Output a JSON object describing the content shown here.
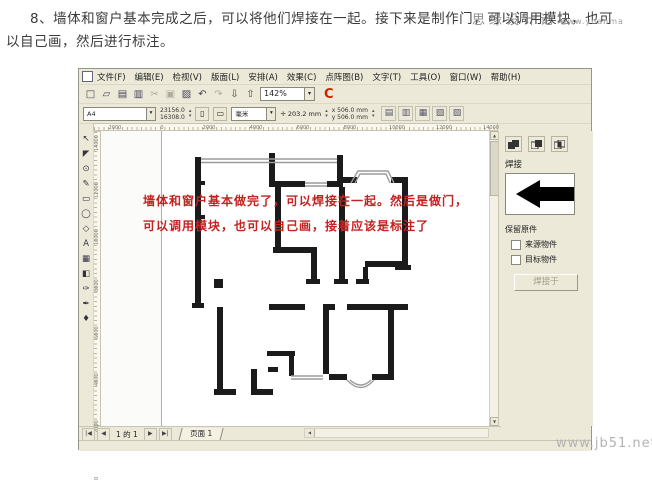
{
  "tutorial": {
    "line1": "8、墙体和窗户基本完成之后，可以将他们焊接在一起。接下来是制作门，可以调用模块，也可",
    "line2": "以自己画，然后进行标注。",
    "watermark_overlay": "思缘设计论坛",
    "watermark_small": "www.yuanma",
    "watermark_bottom": "www.jb51.net"
  },
  "app": {
    "menu": [
      "文件(F)",
      "编辑(E)",
      "检视(V)",
      "版面(L)",
      "安排(A)",
      "效果(C)",
      "点阵图(B)",
      "文字(T)",
      "工具(O)",
      "窗口(W)",
      "帮助(H)"
    ],
    "toolbar": {
      "zoom_level": "142%",
      "logo": "C",
      "icons": [
        {
          "name": "new-document",
          "glyph": "□",
          "gray": false
        },
        {
          "name": "open-folder",
          "glyph": "▱",
          "gray": false
        },
        {
          "name": "save",
          "glyph": "▤",
          "gray": false
        },
        {
          "name": "print",
          "glyph": "▥",
          "gray": false
        },
        {
          "name": "cut",
          "glyph": "✂",
          "gray": true
        },
        {
          "name": "copy",
          "glyph": "▣",
          "gray": true
        },
        {
          "name": "paste",
          "glyph": "▨",
          "gray": false
        },
        {
          "name": "undo",
          "glyph": "↶",
          "gray": false
        },
        {
          "name": "redo",
          "glyph": "↷",
          "gray": true
        },
        {
          "name": "import",
          "glyph": "⇩",
          "gray": false
        },
        {
          "name": "export",
          "glyph": "⇧",
          "gray": false
        }
      ]
    },
    "property_bar": {
      "paper_size": "A4",
      "width_value": "23156.0",
      "height_value": "16308.0",
      "portrait_glyph": "▯",
      "landscape_glyph": "▭",
      "units": "毫米",
      "nudge": "203.2 mm",
      "dup_x": "506.0 mm",
      "dup_y": "506.0 mm",
      "align_icons": [
        "▤",
        "▥",
        "▦",
        "▧",
        "▨"
      ]
    },
    "rulers": {
      "h_labels": [
        "2000",
        "0",
        "2000",
        "4000",
        "6000",
        "8000",
        "10000",
        "12000",
        "14000"
      ],
      "h_positions": [
        21,
        68,
        115,
        162,
        209,
        256,
        303,
        350,
        397
      ],
      "v_labels": [
        "14000",
        "12000",
        "10000",
        "8000",
        "6000",
        "4000",
        "2000",
        "0"
      ],
      "v_positions": [
        11,
        58,
        105,
        152,
        199,
        246,
        293,
        340
      ]
    },
    "toolbox": [
      {
        "name": "pick-tool",
        "glyph": "↖"
      },
      {
        "name": "shape-tool",
        "glyph": "◤"
      },
      {
        "name": "zoom-tool",
        "glyph": "⊙"
      },
      {
        "name": "freehand-tool",
        "glyph": "✎"
      },
      {
        "name": "rectangle-tool",
        "glyph": "▭"
      },
      {
        "name": "ellipse-tool",
        "glyph": "◯"
      },
      {
        "name": "polygon-tool",
        "glyph": "◇"
      },
      {
        "name": "text-tool",
        "glyph": "A"
      },
      {
        "name": "interactive-blend-tool",
        "glyph": "▦"
      },
      {
        "name": "interactive-transparency-tool",
        "glyph": "◧"
      },
      {
        "name": "eyedropper-tool",
        "glyph": "✑"
      },
      {
        "name": "outline-tool",
        "glyph": "✒"
      },
      {
        "name": "fill-tool",
        "glyph": "♦"
      }
    ],
    "docker": {
      "mode_label": "焊接",
      "keep_label": "保留原件",
      "source_label": "来源物件",
      "target_label": "目标物件",
      "apply_label": "焊接于"
    },
    "nav": {
      "first": "|◀",
      "prev": "◀",
      "page_info": "1 的 1",
      "next": "▶",
      "last": "▶|",
      "tab": "页面 1"
    }
  },
  "canvas": {
    "annotation_line1": "墙体和窗户基本做完了，可以焊接在一起。然后是做门，",
    "annotation_line2": "可以调用模块，也可以自己画，接着应该是标注了",
    "annotation_color": "#c52222",
    "floor_plan": {
      "wall_color": "#1b1b1b",
      "window_color": "#9b9b9b",
      "walls": [
        [
          94,
          26,
          6,
          148
        ],
        [
          91,
          172,
          12,
          5
        ],
        [
          100,
          50,
          4,
          4
        ],
        [
          100,
          84,
          4,
          4
        ],
        [
          168,
          22,
          6,
          34
        ],
        [
          168,
          50,
          36,
          6
        ],
        [
          226,
          50,
          16,
          6
        ],
        [
          236,
          24,
          6,
          28
        ],
        [
          236,
          46,
          20,
          6
        ],
        [
          290,
          46,
          17,
          6
        ],
        [
          301,
          46,
          6,
          92
        ],
        [
          294,
          134,
          16,
          5
        ],
        [
          174,
          56,
          6,
          62
        ],
        [
          172,
          116,
          44,
          6
        ],
        [
          210,
          122,
          6,
          28
        ],
        [
          205,
          148,
          14,
          5
        ],
        [
          238,
          56,
          6,
          94
        ],
        [
          233,
          148,
          14,
          5
        ],
        [
          264,
          130,
          43,
          6
        ],
        [
          262,
          136,
          5,
          14
        ],
        [
          255,
          148,
          13,
          5
        ],
        [
          168,
          173,
          36,
          6
        ],
        [
          222,
          173,
          12,
          6
        ],
        [
          246,
          173,
          61,
          6
        ],
        [
          113,
          148,
          9,
          9
        ],
        [
          116,
          176,
          6,
          86
        ],
        [
          113,
          258,
          22,
          6
        ],
        [
          150,
          238,
          6,
          26
        ],
        [
          150,
          258,
          22,
          6
        ],
        [
          166,
          220,
          28,
          5
        ],
        [
          167,
          236,
          10,
          5
        ],
        [
          188,
          225,
          5,
          20
        ],
        [
          222,
          179,
          6,
          64
        ],
        [
          287,
          179,
          6,
          64
        ],
        [
          228,
          243,
          18,
          6
        ],
        [
          271,
          243,
          22,
          6
        ]
      ],
      "window_lines": [
        [
          100,
          28,
          236,
          28
        ],
        [
          100,
          31.5,
          236,
          31.5
        ],
        [
          204,
          52,
          226,
          52
        ],
        [
          204,
          55,
          226,
          55
        ],
        [
          190,
          245,
          222,
          245
        ],
        [
          190,
          248,
          222,
          248
        ]
      ],
      "bay_paths": [
        "M250,52 L257,40 L287,40 L293,52",
        "M254,52 L259,43 L285,43 L289,52",
        "M246,249 Q260,264 273,249",
        "M249,249 Q260,259 270,249"
      ]
    }
  }
}
